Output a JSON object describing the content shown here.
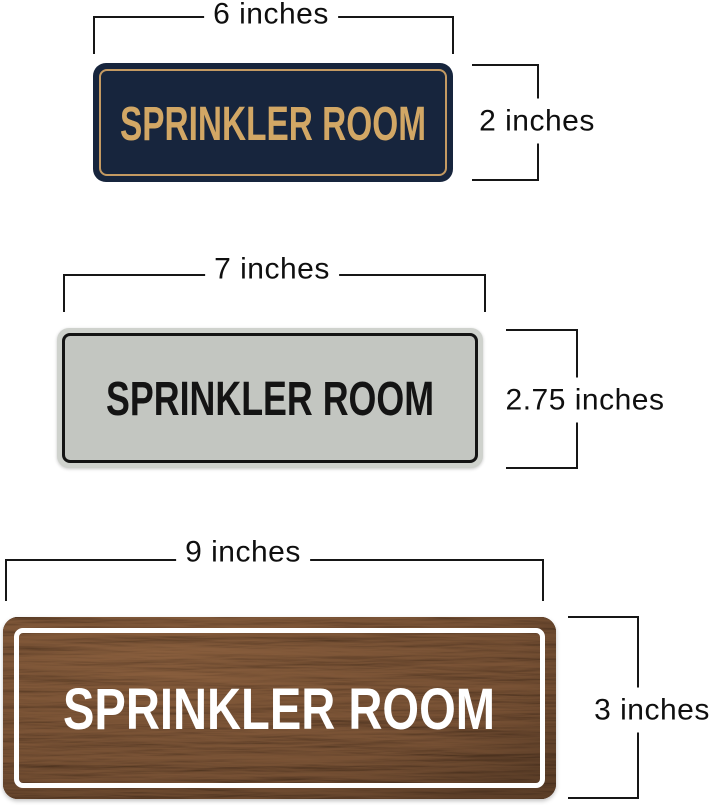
{
  "page": {
    "background": "#ffffff",
    "dimension_line_color": "#161616"
  },
  "signs": [
    {
      "name": "navy-gold-sign",
      "label": "SPRINKLER ROOM",
      "width": "6 inches",
      "height": "2 inches",
      "colors": {
        "background": "#17253d",
        "text": "#d2a765",
        "border": "#c49a62"
      }
    },
    {
      "name": "silver-black-sign",
      "label": "SPRINKLER ROOM",
      "width": "7 inches",
      "height": "2.75 inches",
      "colors": {
        "background": "#c3c6c1",
        "rim": "#cfd2cd",
        "text": "#141414",
        "border": "#141414"
      }
    },
    {
      "name": "walnut-white-sign",
      "label": "SPRINKLER ROOM",
      "width": "9 inches",
      "height": "3 inches",
      "colors": {
        "background": "#53392a",
        "wood_light": "#8a5e3e",
        "text": "#ffffff",
        "border": "#ffffff"
      }
    }
  ]
}
